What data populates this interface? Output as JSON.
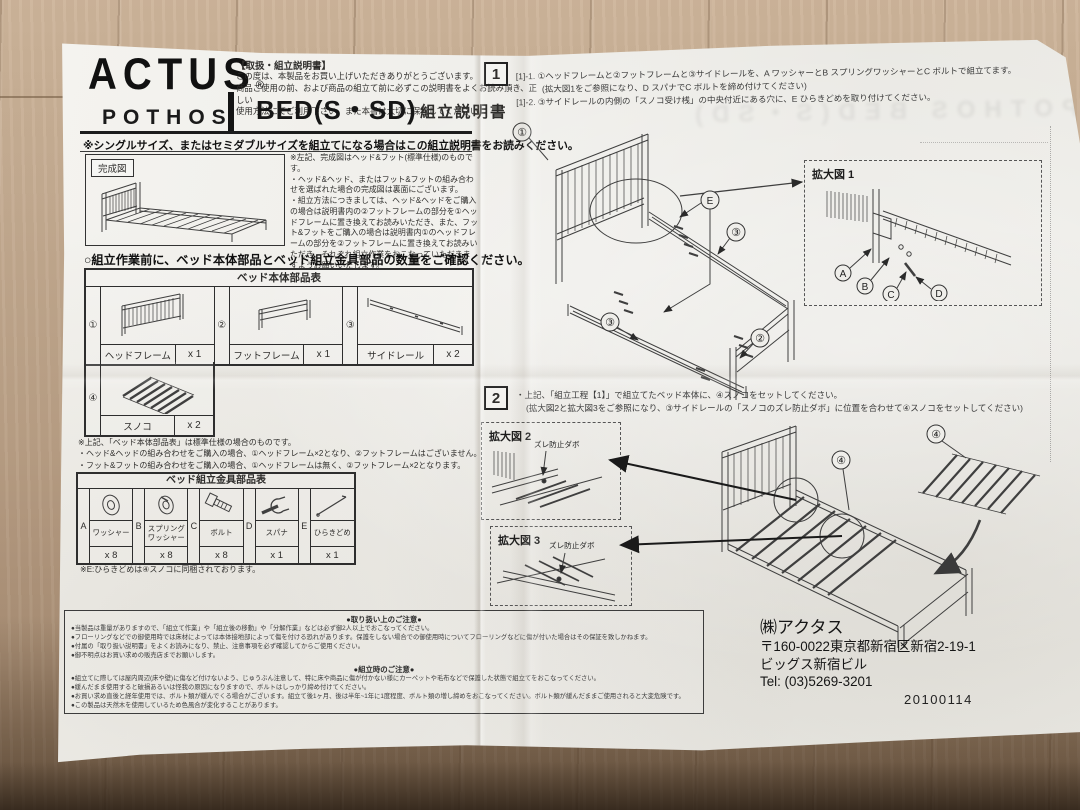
{
  "header": {
    "brand": "ACTUS",
    "reg_mark": "®",
    "series": "POTHOS",
    "doc_tag": "【取扱・組立説明書】",
    "intro": "この度は、本製品をお買い上げいただきありがとうございます。\n商品ご使用の前、および商品の組立て前に必ずこの説明書をよくお読み頂き、正しい\n使用方法にてご利用下さい。また本書は大切に保管してください",
    "product": "BED(S・SD)",
    "doc_title": "組立説明書",
    "size_note": "※シングルサイズ、またはセミダブルサイズを組立てになる場合はこの組立説明書をお読みください。"
  },
  "finished_view": {
    "label": "完成図",
    "notes": "※左記、完成図はヘッド&フット(標準仕様)のものです。\n・ヘッド&ヘッド、またはフット&フットの組み合わせを選ばれた場合の完成図は裏面にございます。\n・組立方法につきましては、ヘッド&ヘッドをご購入の場合は説明書内の②フットフレームの部分を①ヘッドフレームに置き換えてお読みいただき、また、フット&フットをご購入の場合は説明書内①のヘッドフレームの部分を②フットフレームに置き換えてお読みいただき、それぞれ組立作業をおこなっていただきますようお願いいたします。"
  },
  "pre_check": "○組立作業前に、ベッド本体部品とベッド組立金具部品の数量をご確認ください。",
  "body_parts": {
    "title": "ベッド本体部品表",
    "items": [
      {
        "no": "①",
        "name": "ヘッドフレーム",
        "qty": "x 1"
      },
      {
        "no": "②",
        "name": "フットフレーム",
        "qty": "x 1"
      },
      {
        "no": "③",
        "name": "サイドレール",
        "qty": "x 2"
      },
      {
        "no": "④",
        "name": "スノコ",
        "qty": "x 2"
      }
    ],
    "footnote": "※上記、「ベッド本体部品表」は標準仕様の場合のものです。\n・ヘッド&ヘッドの組み合わせをご購入の場合、①ヘッドフレーム×2となり、②フットフレームはございません。\n・フット&フットの組み合わせをご購入の場合、①ヘッドフレームは無く、②フットフレーム×2となります。"
  },
  "hardware": {
    "title": "ベッド組立金具部品表",
    "items": [
      {
        "key": "A",
        "name": "ワッシャー",
        "qty": "x 8"
      },
      {
        "key": "B",
        "name": "スプリング\nワッシャー",
        "qty": "x 8"
      },
      {
        "key": "C",
        "name": "ボルト",
        "qty": "x 8"
      },
      {
        "key": "D",
        "name": "スパナ",
        "qty": "x 1"
      },
      {
        "key": "E",
        "name": "ひらきどめ",
        "qty": "x 1"
      }
    ],
    "footnote": "※E:ひらきどめは④スノコに同梱されております。"
  },
  "step1": {
    "no": "1",
    "line1": "[1]-1. ①ヘッドフレームと②フットフレームと③サイドレールを、A ワッシャーとB スプリングワッシャーとC ボルトで組立てます。",
    "line2": "(拡大図1をご参照になり、D スパナでC ボルトを締め付けてください)",
    "line3": "[1]-2. ③サイドレールの内側の「スノコ受け桟」の中央付近にある穴に、E ひらきどめを取り付けてください。",
    "zoom_label": "拡大図 1",
    "callouts": {
      "head": "①",
      "foot": "②",
      "rail": "③",
      "hirakidome": "E",
      "washer": "A",
      "spring": "B",
      "bolt": "C",
      "spanner": "D"
    }
  },
  "step2": {
    "no": "2",
    "line1": "・上記、「組立工程【1】」で組立てたベッド本体に、④スノコをセットしてください。",
    "line2": "(拡大図2と拡大図3をご参照になり、③サイドレールの「スノコのズレ防止ダボ」に位置を合わせて④スノコをセットしてください)",
    "zoom2_label": "拡大図 2",
    "zoom3_label": "拡大図 3",
    "dowel_label": "ズレ防止ダボ",
    "sunoko_callout": "④"
  },
  "notes": {
    "handling_title": "●取り扱い上のご注意●",
    "handling": "●当製品は重量がありますので、「組立て作業」や「組立後の移動」や「分解作業」などは必ず御2人以上でおこなってください。\n●フローリングなどでの御使用時では床材によっては本体接地部によって傷を付ける恐れがあります。保護をしない場合での御使用時についてフローリングなどに傷が付いた場合はその保証を致しかねます。\n●付属の「取り扱い説明書」をよくお読みになり、禁止、注意事項を必ず確認してからご使用ください。\n●御不明点はお買い求めの販売店までお願いします。",
    "assembly_title": "●組立時のご注意●",
    "assembly": "●組立てに際しては屋内周辺(床や壁)に傷など付けないよう、じゅうぶん注意して、特に床や商品に傷が付かない様にカーペットや毛布などで保護した状態で組立てをおこなってください。\n●緩んだまま使用すると破損あるいは怪我の原因になりますので、ボルトはしっかり締め付けてください。\n●お買い求め直後と経年使用では、ボルト類が緩んでくる場合がございます。組立て後1ヶ月、後は半年~1年に1度程度、ボルト類の増し締めをおこなってください。ボルト類が緩んだままご使用されると大変危険です。\n●この製品は天然木を使用しているため色風合が変化することがあります。"
  },
  "company": {
    "name": "㈱アクタス",
    "postal_address": "〒160-0022東京都新宿区新宿2-19-1",
    "building": "ビッグス新宿ビル",
    "tel": "Tel: (03)5269-3201",
    "date": "20100114"
  },
  "ghost": {
    "text": "POTHOS BED(S・SD)"
  }
}
